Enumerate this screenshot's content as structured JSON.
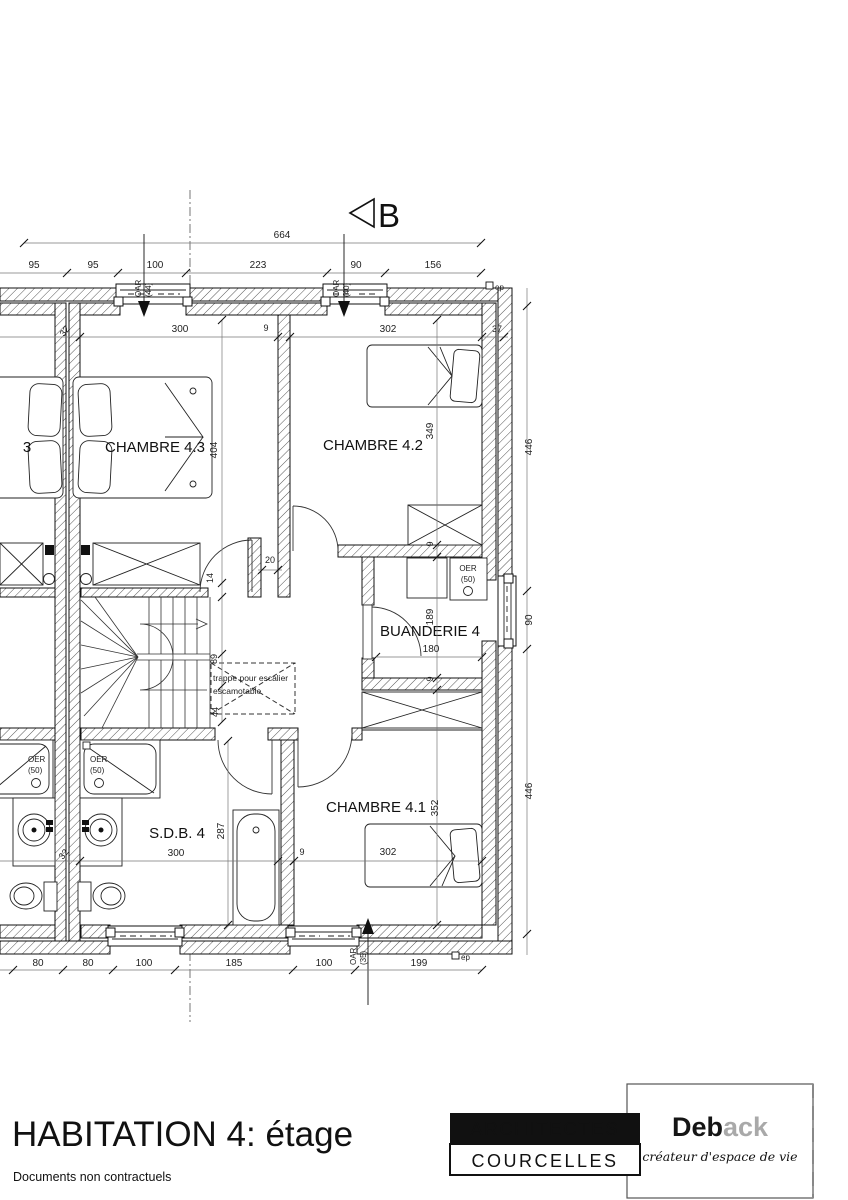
{
  "section_marker": {
    "label": "B"
  },
  "dims": {
    "top_total": "664",
    "top_row": [
      "95",
      "95",
      "100",
      "223",
      "90",
      "156"
    ],
    "bottom_row": [
      "80",
      "80",
      "100",
      "185",
      "100",
      "199"
    ],
    "right_col": [
      "446",
      "90",
      "446"
    ],
    "row1": [
      "32",
      "300",
      "9",
      "302",
      "37"
    ],
    "row2": [
      "32",
      "300",
      "9",
      "302"
    ],
    "chain_left": [
      "404",
      "14",
      "89",
      "44"
    ],
    "chain_right": [
      "349",
      "9",
      "189",
      "9",
      "352"
    ],
    "buanderie_width": "180",
    "bath_height": "287",
    "door_offset": "20"
  },
  "rooms": {
    "c43": "CHAMBRE 4.3",
    "c42": "CHAMBRE 4.2",
    "c41": "CHAMBRE 4.1",
    "buanderie": "BUANDERIE 4",
    "sdb": "S.D.B.  4",
    "mirror_partial": "3"
  },
  "windows": {
    "w1": [
      "OAR",
      "(44)"
    ],
    "w2": [
      "OAR",
      "(40)"
    ],
    "w4": [
      "OAR",
      "(35)"
    ]
  },
  "fixtures": {
    "oer_label": "OER",
    "oer_size": "(50)"
  },
  "notes": {
    "trappe_line1": "trappe pour escalier",
    "trappe_line2": "escamotable",
    "ep": "ep"
  },
  "footer": {
    "title": "HABITATION 4: étage",
    "disclaimer": "Documents non contractuels",
    "firm_line1": "ARCHITECTES",
    "firm_line2": "COURCELLES",
    "logo_part1": "Deb",
    "logo_part2": "ack",
    "tagline": "créateur d'espace de vie"
  }
}
